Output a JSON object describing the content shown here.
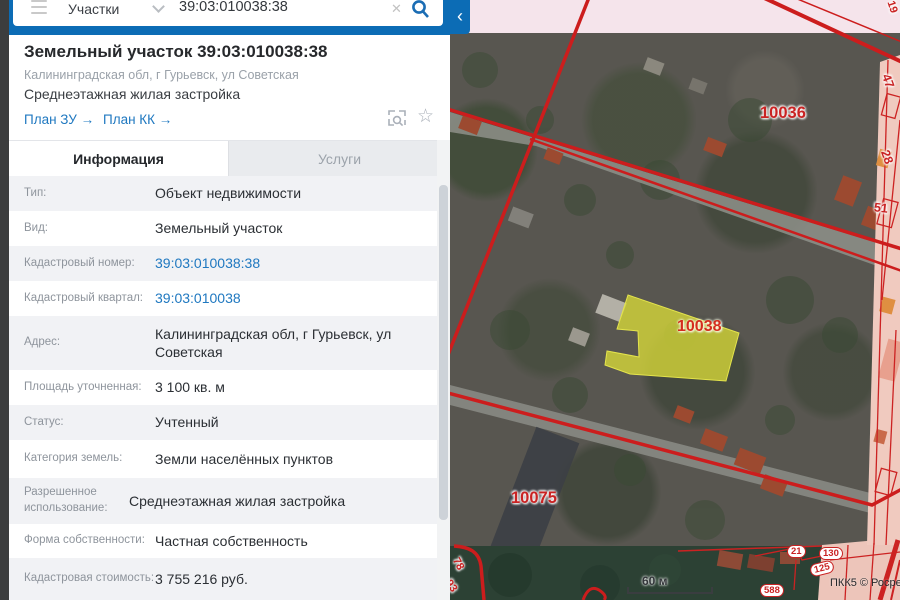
{
  "search_bar": {
    "category": "Участки",
    "query": "39:03:010038:38",
    "clear_glyph": "✕"
  },
  "panel": {
    "header": {
      "title": "Земельный участок 39:03:010038:38",
      "address": "Калининградская обл, г Гурьевск, ул Советская",
      "usage": "Среднеэтажная жилая застройка",
      "link_plan_zu": "План ЗУ →",
      "link_plan_kk": "План КК →",
      "star_glyph": "☆"
    },
    "tabs": [
      {
        "label": "Информация",
        "active": true
      },
      {
        "label": "Услуги",
        "active": false
      }
    ],
    "rows": [
      {
        "label": "Тип:",
        "value": "Объект недвижимости"
      },
      {
        "label": "Вид:",
        "value": "Земельный участок"
      },
      {
        "label": "Кадастровый номер:",
        "value": "39:03:010038:38"
      },
      {
        "label": "Кадастровый квартал:",
        "value": "39:03:010038"
      },
      {
        "label": "Адрес:",
        "value": "Калининградская обл, г Гурьевск, ул Советская"
      },
      {
        "label": "Площадь уточненная:",
        "value": "3 100 кв. м"
      },
      {
        "label": "Статус:",
        "value": "Учтенный"
      },
      {
        "label": "Категория земель:",
        "value": "Земли населённых пунктов"
      },
      {
        "label": "Разрешенное использование:",
        "value": "Среднеэтажная жилая застройка"
      },
      {
        "label": "Форма собственности:",
        "value": "Частная собственность"
      },
      {
        "label": "Кадастровая стоимость:",
        "value": "3 755 216 руб."
      }
    ]
  },
  "map": {
    "highlighted_parcel": {
      "label": "10038"
    },
    "quarters": {
      "q10036": "10036",
      "q10075": "10075"
    },
    "edge_parcels": {
      "p19": "19",
      "p47": "47",
      "p28": "28",
      "p51": "51",
      "p21": "21",
      "p130": "130",
      "p125": "125",
      "p588": "588",
      "p78": "78",
      "p93": "93"
    },
    "scale_label": "60 м",
    "attribution": "ПКК5 © Росре",
    "collapse_arrow": "‹"
  },
  "colors": {
    "accent_blue": "#0c6cb5",
    "boundary_red": "#cc1d1d",
    "parcel_yellow": "#d9da39"
  }
}
